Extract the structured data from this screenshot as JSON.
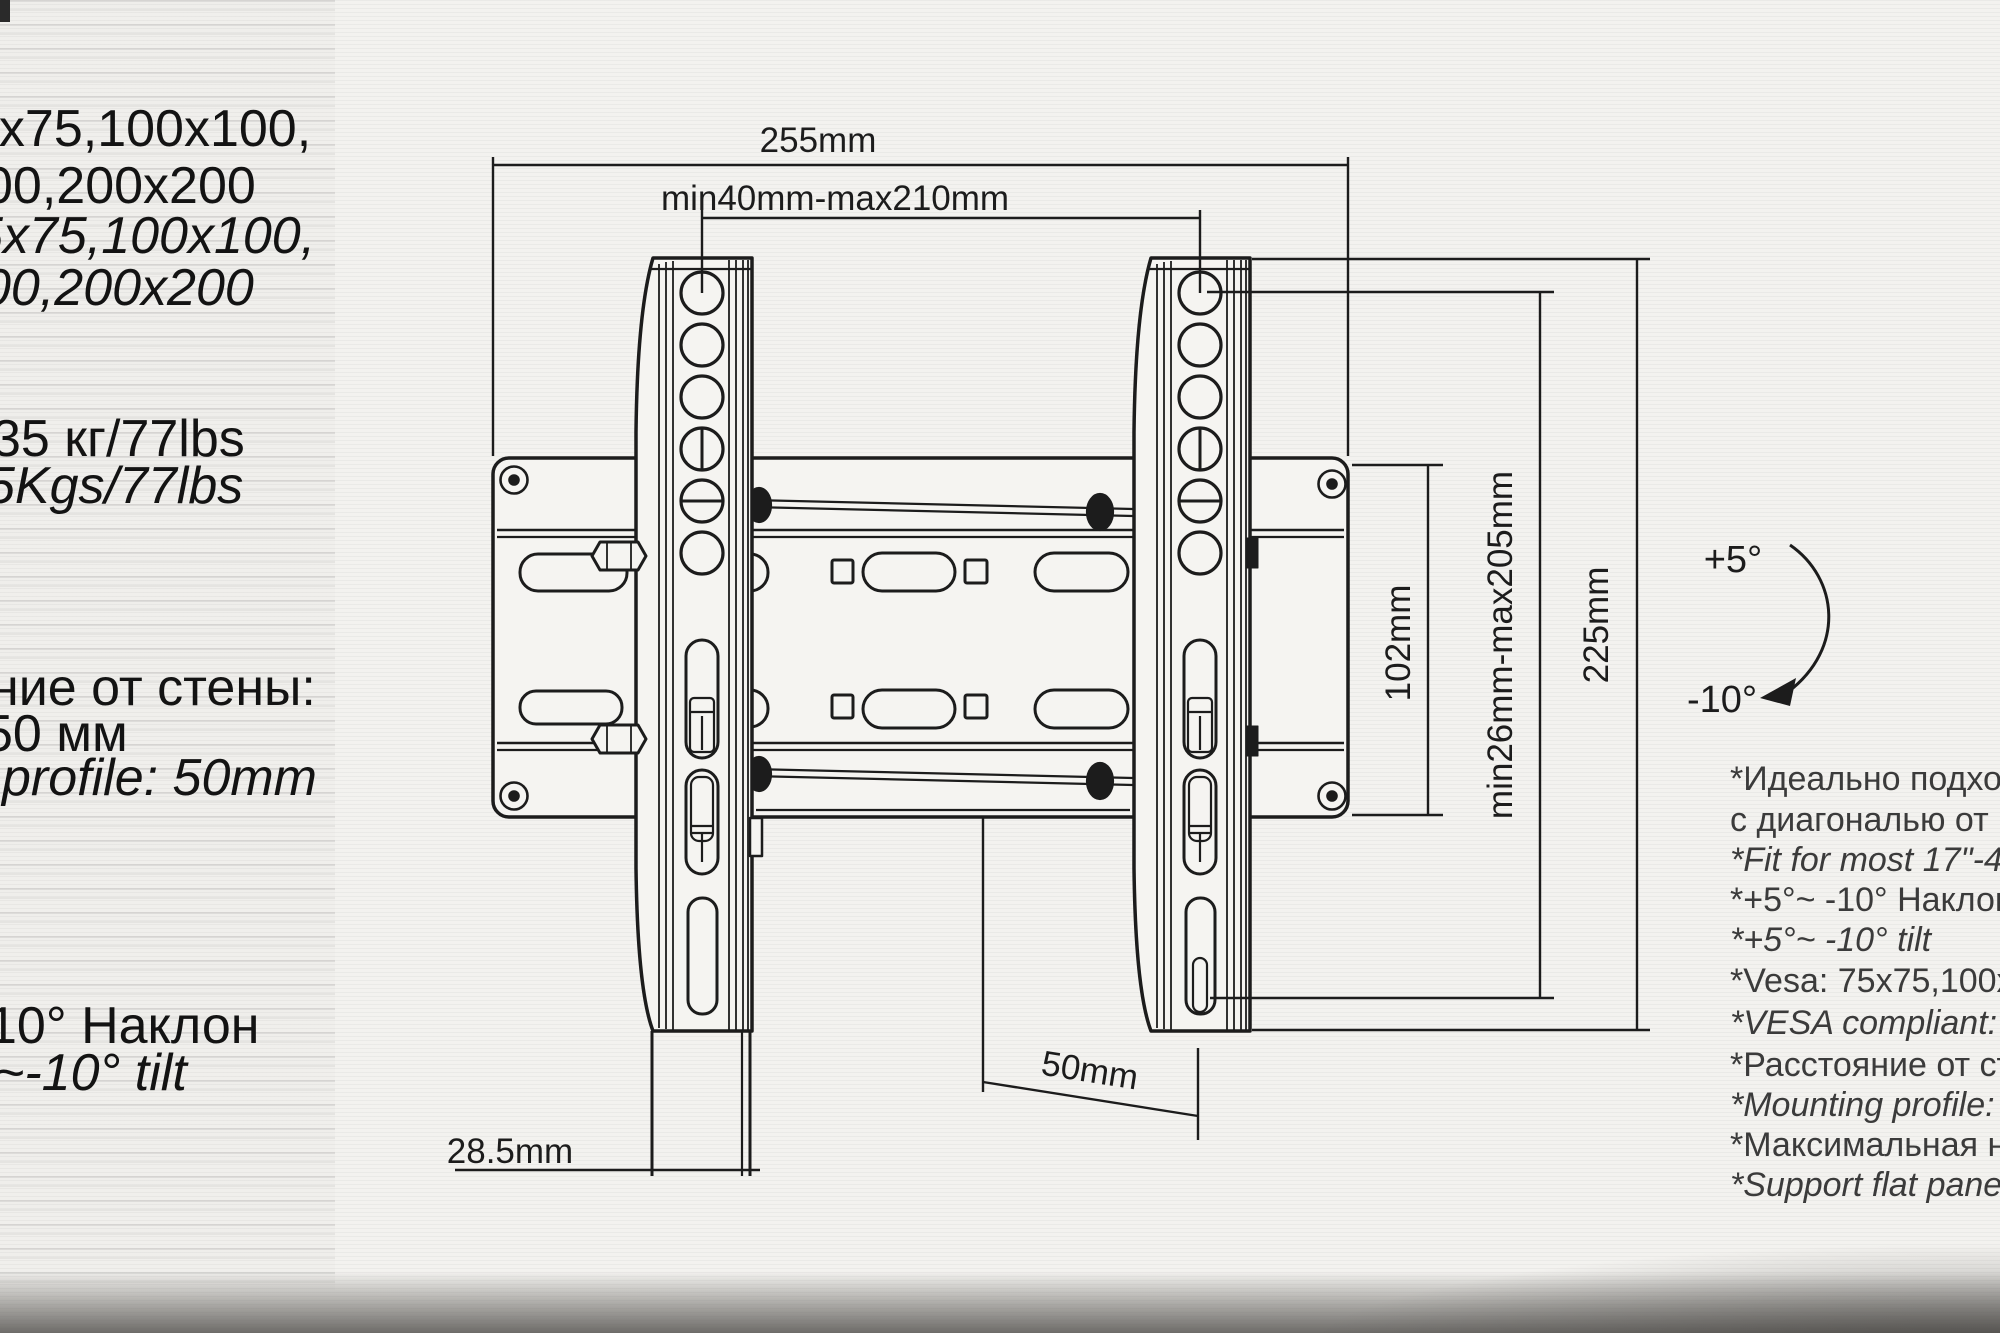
{
  "left_panel": {
    "lines": [
      {
        "text": "5x75,100x100,"
      },
      {
        "text": "00,200x200"
      },
      {
        "text": "5x75,100x100,"
      },
      {
        "text": "00,200x200"
      },
      {
        "text": "35 кг/77lbs"
      },
      {
        "text": "5Kgs/77lbs"
      },
      {
        "text": "ние от стены:"
      },
      {
        "text": "50 мм"
      },
      {
        "text": "profile: 50mm"
      },
      {
        "text": "10° Наклон"
      },
      {
        "text": "~-10° tilt"
      }
    ]
  },
  "diagram": {
    "labels": {
      "width_total": "255mm",
      "hole_spacing": "min40mm-max210mm",
      "plate_height": "102mm",
      "vertical_range": "min26mm-max205mm",
      "rail_height": "225mm",
      "wall_offset": "50mm",
      "bottom_width": "28.5mm",
      "tilt_up": "+5°",
      "tilt_down": "-10°"
    }
  },
  "notes": {
    "lines": [
      {
        "text": "*Идеально подхо"
      },
      {
        "text": " с диагональю от"
      },
      {
        "text": "*Fit for most 17\"-4"
      },
      {
        "text": "*+5°~ -10° Наклон"
      },
      {
        "text": "*+5°~ -10° tilt"
      },
      {
        "text": "*Vesa: 75x75,100x"
      },
      {
        "text": "*VESA compliant:"
      },
      {
        "text": "*Расстояние от ст"
      },
      {
        "text": "*Mounting profile:"
      },
      {
        "text": "*Максимальная н"
      },
      {
        "text": "*Support flat pane"
      }
    ]
  }
}
